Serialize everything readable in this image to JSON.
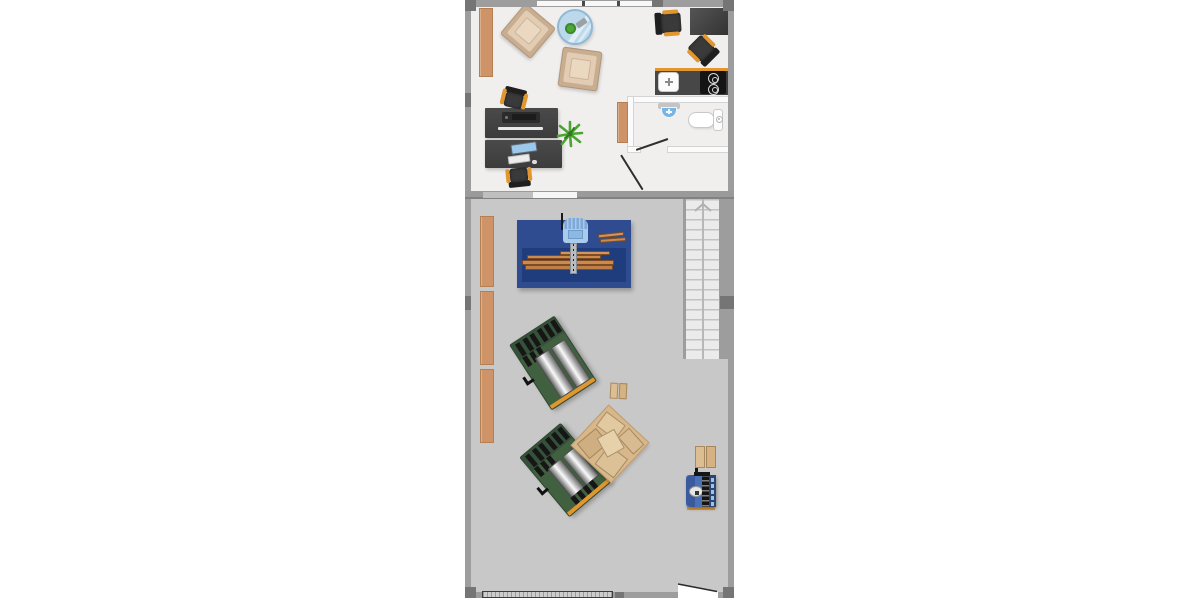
{
  "scene": {
    "type": "architectural floor plan, top-down",
    "areas": [
      {
        "id": "office",
        "description": "furnished office / studio room with kitchenette and bathroom (light floor, top section)"
      },
      {
        "id": "workshop",
        "description": "wood workshop / garage hall (gray floor, bottom section) with staircase"
      }
    ]
  },
  "office": {
    "items": [
      "tall bookshelf on left wall",
      "armchair (rotated)",
      "armchair",
      "round glass side table with small plant and ornament",
      "square dark side table in top-right corner",
      "office chair",
      "office chair (angled)",
      "kitchenette counter with sink and 2-burner cooktop",
      "bathroom: wall basin",
      "bathroom: toilet with cistern",
      "wall shelf beside bathroom",
      "desk with printer",
      "desk with monitor, keyboard and mouse",
      "desk chair (top)",
      "desk chair (bottom)",
      "potted plant",
      "hinged interior door (office entry)",
      "hinged bathroom door",
      "window band in top wall"
    ]
  },
  "workshop": {
    "items": [
      "wall shelf 1",
      "wall shelf 2",
      "wall shelf 3",
      "blue panel-saw workbench with sliding head and stacked lumber",
      "loose plank pair on bench",
      "staircase going up (arrow)",
      "green planer machine 1 (rotated)",
      "green planer machine 2 (rotated)",
      "large lumber stack (rotated pallet)",
      "small lumber bundle near stack",
      "small lumber bundle near bench machine",
      "blue benchtop machine (grinder/bandsaw)",
      "wide garage/roller door in bottom wall",
      "exterior hinged door (bottom right)"
    ]
  },
  "colors": {
    "office_floor": "#f0efee",
    "workshop_floor": "#c8c8c8",
    "stairs_floor": "#ebebeb",
    "wall": "#9d9d9d",
    "wall_dark": "#757575",
    "wood": "#ce9467",
    "accent_orange": "#e2972e",
    "plank": "#cd8a4e",
    "machine_table_blue": "#2e4c8f",
    "machine_table_band": "#1f3c7c",
    "saw_head_blue": "#a9cbec",
    "machine_green": "#41603f",
    "small_machine_blue": "#4a70b8",
    "glass_blue": "#bcd9ec",
    "bath_fixture_blue": "#7ab4e0",
    "plant_green": "#4ca332",
    "chair_dark": "#333333"
  }
}
